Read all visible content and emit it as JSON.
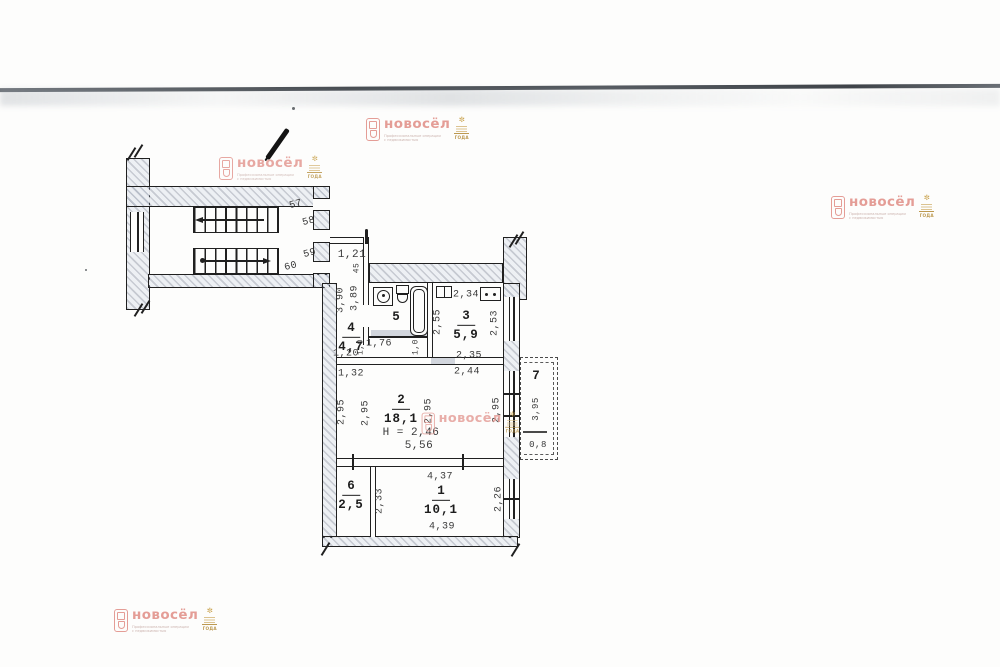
{
  "watermark": {
    "brand": "новосёл",
    "tagline_line1": "Профессиональные операции",
    "tagline_line2": "с недвижимостью",
    "badge_text": "ГОДА",
    "brand_color": "#e2938c",
    "badge_color": "#b68f3e"
  },
  "plan": {
    "rooms": {
      "r1": {
        "num": "1",
        "area": "10,1"
      },
      "r2": {
        "num": "2",
        "area": "18,1"
      },
      "r3": {
        "num": "3",
        "area": "5,9"
      },
      "r4": {
        "num": "4",
        "area": "4,7"
      },
      "r5": {
        "num": "5"
      },
      "r6": {
        "num": "6",
        "area": "2,5"
      },
      "r7": {
        "num": "7"
      }
    },
    "units": {
      "u57": "57",
      "u58": "58",
      "u59": "59",
      "u60": "60"
    },
    "dims": {
      "entry_width": "1,21",
      "entry_small": "45",
      "hall_len_a": "3,90",
      "hall_len_b": "3,89",
      "hall_w_a": "1,20",
      "hall_w_b": "1,32",
      "bath_w": "1,76",
      "bath_side_l": "1,0",
      "bath_side_r": "1,0",
      "kitchen_top": "2,34",
      "kitchen_left_h": "2,55",
      "kitchen_right_h": "2,53",
      "kitchen_w": "2,35",
      "kitchen_w_outer": "2,44",
      "room2_h_a": "2,95",
      "room2_h_b": "2,95",
      "room2_h_c": "2,95",
      "room2_h_d": "2,95",
      "ceiling_note": "Н = 2,46",
      "room2_w": "5,56",
      "room1_top": "4,37",
      "room1_bottom": "4,39",
      "room1_right": "2,26",
      "room6_h": "2,33",
      "balcony_len": "3,95",
      "balcony_w": "0,8"
    }
  }
}
